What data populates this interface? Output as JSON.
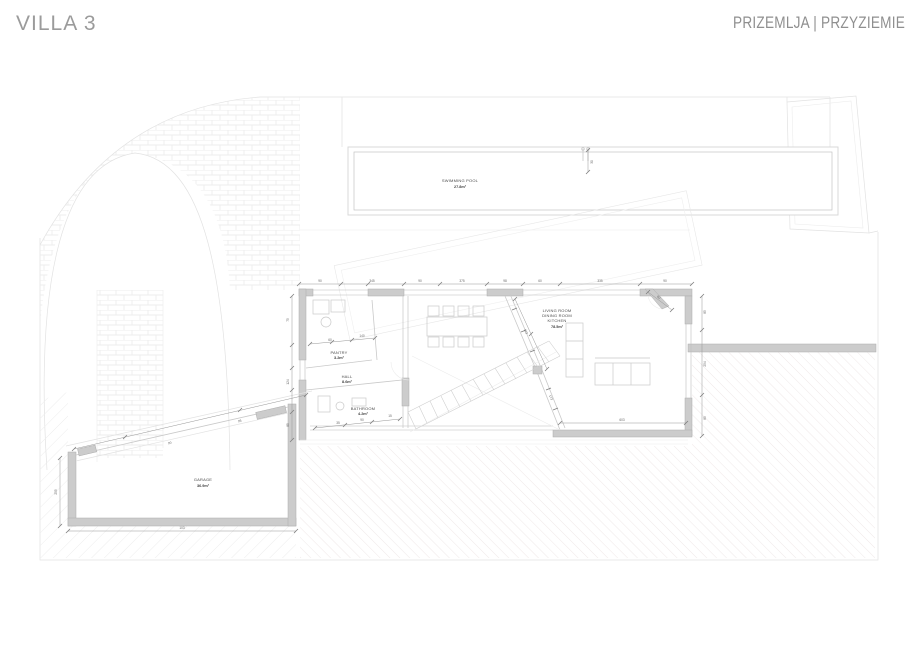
{
  "header": {
    "title": "VILLA 3",
    "subtitle": "PRIZEMLJA | PRZYZIEMIE"
  },
  "rooms": {
    "pool": {
      "name": "SWIMMING POOL",
      "area": "27.8m²"
    },
    "pantry": {
      "name": "PANTRY",
      "area": "3.2m²"
    },
    "hall": {
      "name": "HALL",
      "area": "8.6m²"
    },
    "bathroom": {
      "name": "BATHROOM",
      "area": "4.2m²"
    },
    "living": {
      "line1": "LIVING ROOM",
      "line2": "DINING ROOM",
      "line3": "KITCHEN",
      "area": "78.5m²"
    },
    "garage": {
      "name": "GARAGE",
      "area": "36.9m²"
    }
  },
  "dims": [
    {
      "t": "90"
    },
    {
      "t": "345"
    },
    {
      "t": "90"
    },
    {
      "t": "375"
    },
    {
      "t": "98"
    },
    {
      "t": "60"
    },
    {
      "t": "335"
    },
    {
      "t": "90"
    },
    {
      "t": "85"
    },
    {
      "t": "254"
    },
    {
      "t": "85"
    },
    {
      "t": "75"
    },
    {
      "t": "124"
    },
    {
      "t": "85"
    },
    {
      "t": "603"
    },
    {
      "t": "103"
    },
    {
      "t": "255"
    },
    {
      "t": "90"
    },
    {
      "t": "95"
    },
    {
      "t": "60"
    },
    {
      "t": "140"
    },
    {
      "t": "35"
    },
    {
      "t": "90"
    },
    {
      "t": "15"
    },
    {
      "t": "123"
    },
    {
      "t": "173"
    },
    {
      "t": "90"
    },
    {
      "t": "30"
    }
  ],
  "colors": {
    "title_gray": "#9b9b9b",
    "wall_gray": "#cccccc",
    "line_gray": "#d9d9d9",
    "dim_gray": "#8f8f8f",
    "hatch_pink": "#efe8e8",
    "label_text": "#4a4a4a"
  }
}
